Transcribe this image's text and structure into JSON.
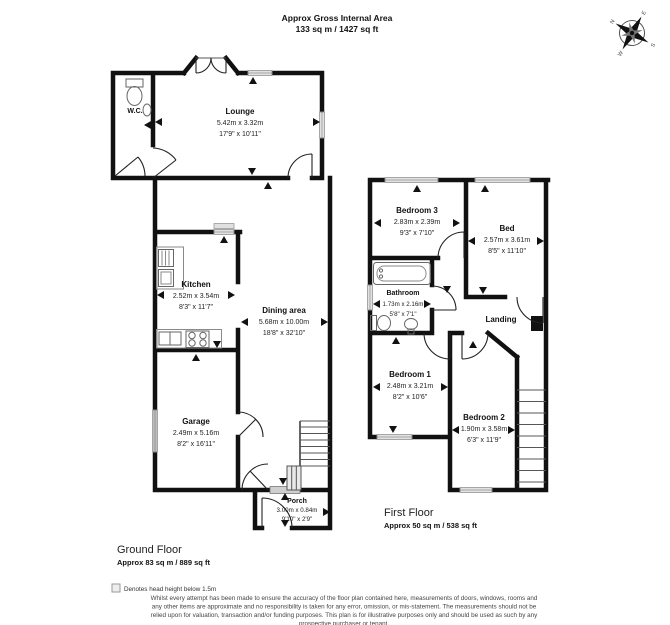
{
  "header": {
    "title": "Approx Gross Internal Area",
    "area": "133 sq m / 1427 sq ft"
  },
  "compass": {
    "n": "N",
    "e": "E",
    "s": "S",
    "w": "W"
  },
  "ground_floor": {
    "title": "Ground Floor",
    "area": "Approx 83 sq m / 889 sq ft",
    "rooms": {
      "wc": {
        "name": "W.C."
      },
      "lounge": {
        "name": "Lounge",
        "metric": "5.42m x 3.32m",
        "imperial": "17'9\" x 10'11\""
      },
      "kitchen": {
        "name": "Kitchen",
        "metric": "2.52m x 3.54m",
        "imperial": "8'3\" x 11'7\""
      },
      "dining": {
        "name": "Dining area",
        "metric": "5.68m x 10.00m",
        "imperial": "18'8\" x 32'10\""
      },
      "garage": {
        "name": "Garage",
        "metric": "2.49m x 5.16m",
        "imperial": "8'2\" x 16'11\""
      },
      "porch": {
        "name": "Porch",
        "metric": "3.00m x 0.84m",
        "imperial": "9'10\" x 2'9\""
      }
    }
  },
  "first_floor": {
    "title": "First Floor",
    "area": "Approx 50 sq m / 538 sq ft",
    "rooms": {
      "bedroom3": {
        "name": "Bedroom 3",
        "metric": "2.83m x 2.39m",
        "imperial": "9'3\" x 7'10\""
      },
      "bed": {
        "name": "Bed",
        "metric": "2.57m x 3.61m",
        "imperial": "8'5\" x 11'10\""
      },
      "bathroom": {
        "name": "Bathroom",
        "metric": "1.73m x 2.16m",
        "imperial": "5'8\" x 7'1\""
      },
      "landing": {
        "name": "Landing"
      },
      "bedroom1": {
        "name": "Bedroom 1",
        "metric": "2.48m x 3.21m",
        "imperial": "8'2\" x 10'6\""
      },
      "bedroom2": {
        "name": "Bedroom 2",
        "metric": "1.90m x 3.58m",
        "imperial": "6'3\" x 11'9\""
      }
    }
  },
  "footer": {
    "note": "Denotes head height below 1.5m",
    "disclaimer": [
      "Whilst every attempt has been made to ensure the accuracy of the floor plan contained here, measurements of doors, windows, rooms and",
      "any other items are approximate and no responsibility is taken for any error, omission, or mis-statement. The measurements should not be",
      "relied upon for valuation, transaction and/or funding purposes. This plan is for illustrative purposes only and should be used as such by any",
      "prospective purchaser or tenant."
    ]
  },
  "colors": {
    "wall": "#111111",
    "marker": "#111111",
    "shade": "#e0e0e0"
  }
}
